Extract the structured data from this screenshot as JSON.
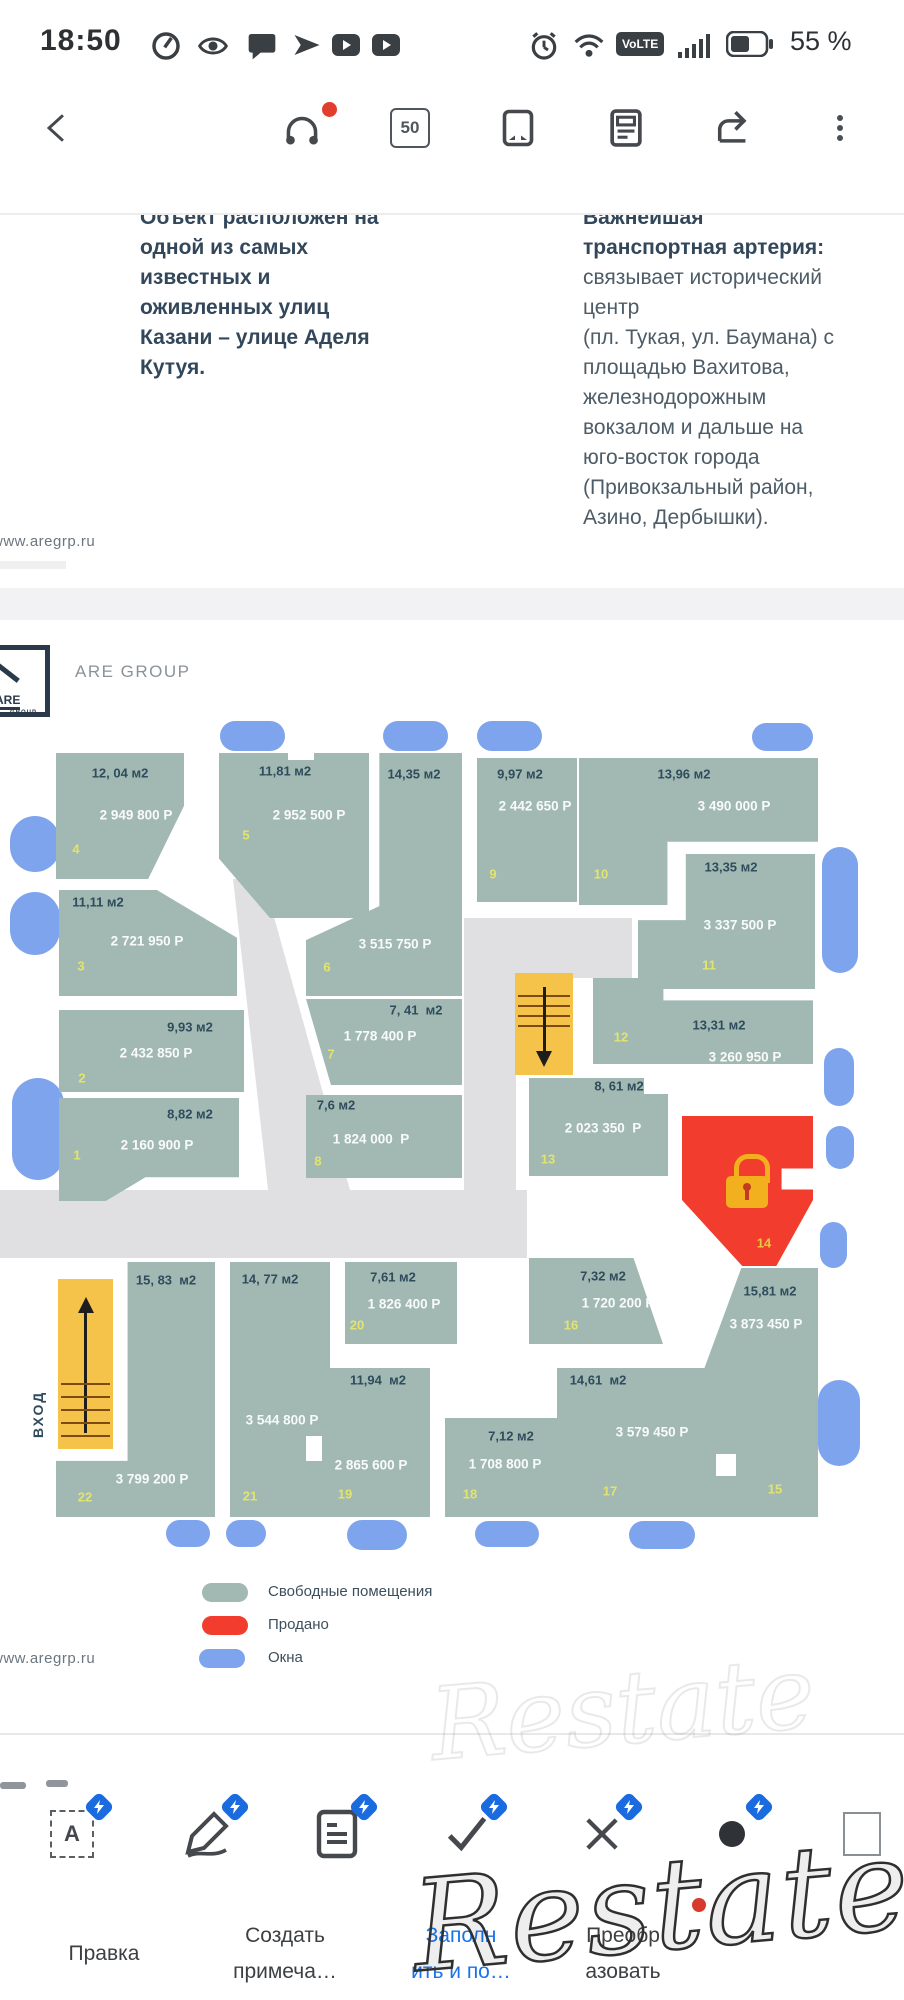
{
  "status_bar": {
    "time": "18:50",
    "volte": "VoLTE",
    "battery_percent": "55 %",
    "left_icons": [
      "speedometer-icon",
      "eye-icon",
      "chat-icon",
      "send-icon",
      "video-icon",
      "video-icon"
    ],
    "right_icons": [
      "alarm-icon",
      "wifi-icon",
      "volte-badge",
      "signal-icon",
      "battery-icon"
    ]
  },
  "toolbar": {
    "page_badge": "50",
    "icons": [
      "back-icon",
      "headphones-icon",
      "page-count-badge",
      "fit-page-icon",
      "reader-view-icon",
      "share-icon",
      "overflow-menu-icon"
    ]
  },
  "page1": {
    "left_column": [
      "Объект расположен на",
      "одной из самых",
      "известных и",
      "оживленных улиц",
      "Казани – улице Аделя",
      "Кутуя."
    ],
    "right_column_bold": [
      "Важнейшая",
      "транспортная артерия:"
    ],
    "right_column": [
      "связывает исторический",
      "центр",
      "(пл. Тукая, ул. Баумана) с",
      "площадью Вахитова,",
      "железнодорожным",
      "вокзалом и дальше на",
      "юго-восток города",
      "(Привокзальный район,",
      "Азино, Дербышки)."
    ],
    "url": "www.aregrp.ru"
  },
  "plan": {
    "brand": "ARE GROUP",
    "logo_are": "ARE",
    "logo_group": "GROUP",
    "entrance": "ВХОД",
    "url": "www.aregrp.ru",
    "colors": {
      "free": "#a2b9b3",
      "sold": "#f23d2e",
      "window": "#7ea4ee",
      "stairs": "#f6c34a",
      "corridor": "#e0e0e2"
    },
    "legend": [
      {
        "label": "Свободные помещения",
        "color": "#a2b9b3"
      },
      {
        "label": "Продано",
        "color": "#f23d2e"
      },
      {
        "label": "Окна",
        "color": "#7ea4ee"
      }
    ],
    "units": [
      {
        "num": "1",
        "area": "8,82 м2",
        "price": "2 160 900 Р"
      },
      {
        "num": "2",
        "area": "9,93 м2",
        "price": "2 432 850 Р"
      },
      {
        "num": "3",
        "area": "11,11 м2",
        "price": "2 721 950 Р"
      },
      {
        "num": "4",
        "area": "12, 04 м2",
        "price": "2 949 800 Р"
      },
      {
        "num": "5",
        "area": "11,81 м2",
        "price": "2 952 500 Р"
      },
      {
        "num": "6",
        "area": "14,35 м2",
        "price": "3 515 750 Р"
      },
      {
        "num": "7",
        "area": "7, 41  м2",
        "price": "1 778 400 Р"
      },
      {
        "num": "8",
        "area": "7,6 м2",
        "price": "1 824 000  Р"
      },
      {
        "num": "9",
        "area": "9,97 м2",
        "price": "2 442 650 Р"
      },
      {
        "num": "10",
        "area": "13,96 м2",
        "price": "3 490 000 Р"
      },
      {
        "num": "11",
        "area": "13,35 м2",
        "price": "3 337 500 Р"
      },
      {
        "num": "12",
        "area": "13,31 м2",
        "price": "3 260 950 Р"
      },
      {
        "num": "13",
        "area": "8, 61 м2",
        "price": "2 023 350  Р"
      },
      {
        "num": "14",
        "sold": true
      },
      {
        "num": "15",
        "area": "15,81 м2",
        "price": "3 873 450 Р"
      },
      {
        "num": "16",
        "area": "7,32 м2",
        "price": "1 720 200 Р"
      },
      {
        "num": "17",
        "area": "14,61  м2",
        "price": "3 579 450 Р"
      },
      {
        "num": "18",
        "area": "7,12 м2",
        "price": "1 708 800 Р"
      },
      {
        "num": "19",
        "area": "11,94  м2",
        "price": "2 865 600 Р"
      },
      {
        "num": "20",
        "area": "7,61 м2",
        "price": "1 826 400 Р"
      },
      {
        "num": "21",
        "area": "14, 77 м2",
        "price": "3 544 800 Р"
      },
      {
        "num": "22",
        "area": "15, 83  м2",
        "price": "3 799 200 Р"
      }
    ]
  },
  "bottom_toolbar": {
    "icon_a": "A",
    "tabs": [
      {
        "line1": "Правка",
        "line2": ""
      },
      {
        "line1": "Создать",
        "line2": "примеча…"
      },
      {
        "line1": "Заполн",
        "line2": "ить и по…"
      },
      {
        "line1": "Преобр",
        "line2": "азовать"
      }
    ]
  },
  "watermark": "Restate"
}
